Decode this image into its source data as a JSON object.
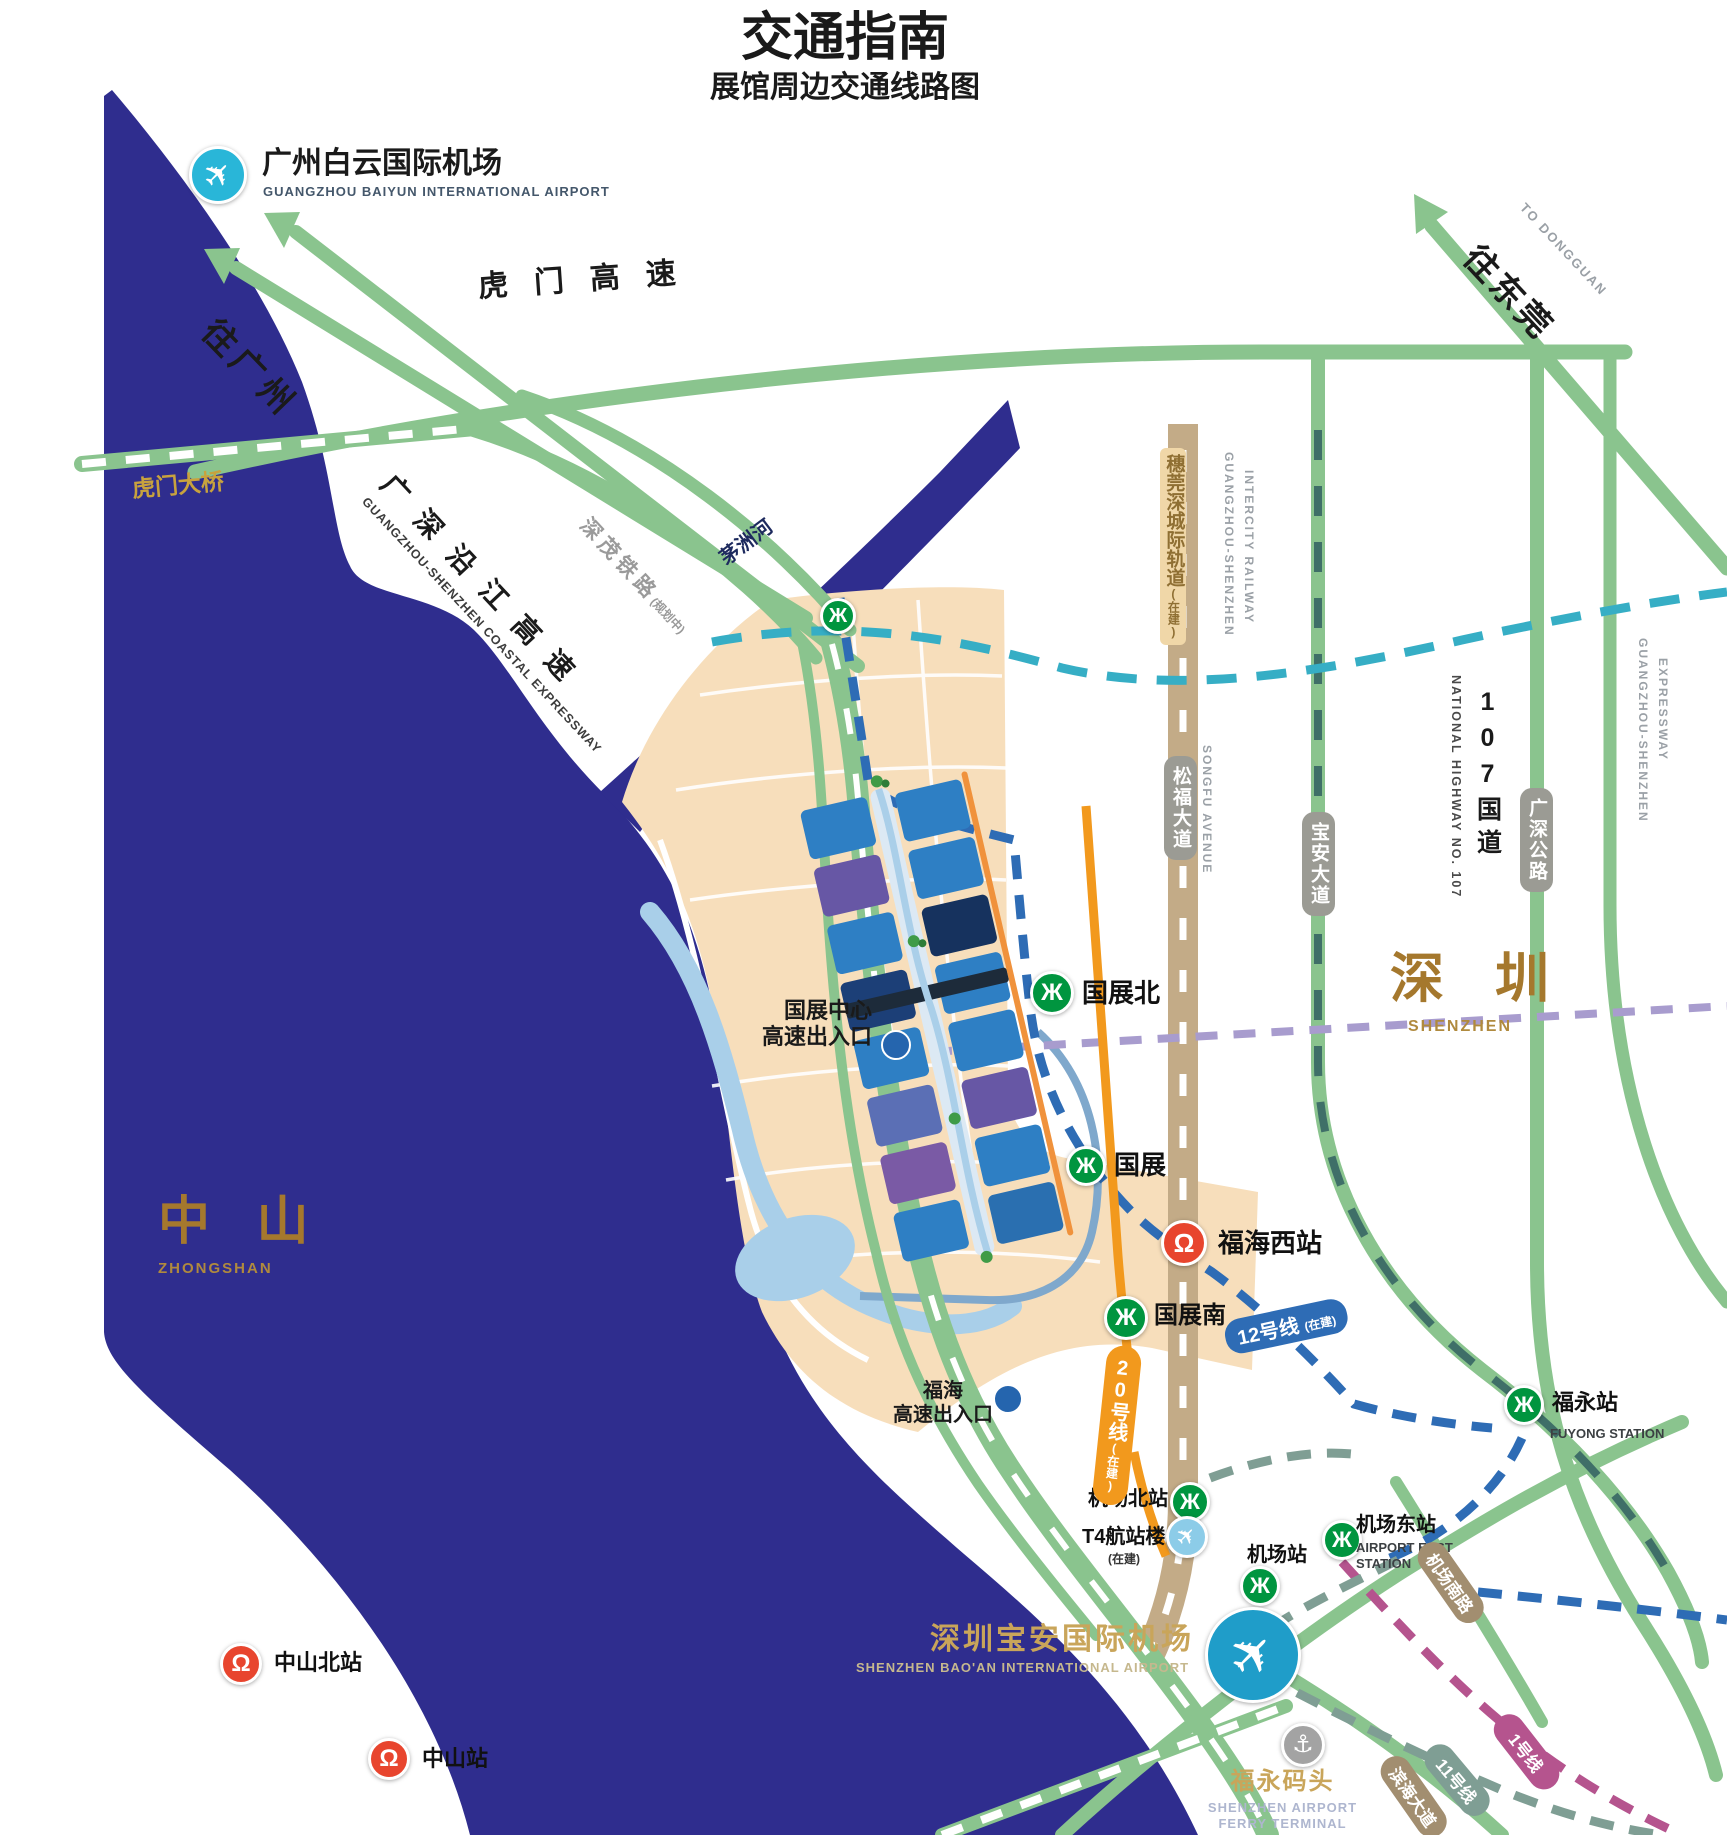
{
  "title": "交通指南",
  "subtitle": "展馆周边交通线路图",
  "airports": {
    "baiyun": {
      "zh": "广州白云国际机场",
      "en": "GUANGZHOU BAIYUN INTERNATIONAL AIRPORT"
    },
    "baoan": {
      "zh": "深圳宝安国际机场",
      "en": "SHENZHEN BAO'AN INTERNATIONAL AIRPORT"
    },
    "t4": {
      "zh": "T4航站楼",
      "note": "(在建)"
    }
  },
  "regions": {
    "shenzhen": {
      "zh": "深 圳",
      "en": "SHENZHEN"
    },
    "zhongshan": {
      "zh": "中 山",
      "en": "ZHONGSHAN"
    }
  },
  "directions": {
    "to_guangzhou": "往广州",
    "to_dongguan": {
      "zh": "往东莞",
      "en": "TO DONGGUAN"
    }
  },
  "roads": {
    "humen_expwy": "虎门高速",
    "humen_bridge": "虎门大桥",
    "coastal": {
      "zh": "广深沿江高速",
      "en": "GUANGZHOU-SHENZHEN COASTAL EXPRESSWAY"
    },
    "shenmao": {
      "zh": "深茂铁路",
      "note": "(规划中)"
    },
    "maozhou_river": "茅洲河",
    "intercity": {
      "zh": "穗莞深城际轨道",
      "note": "(在建)",
      "en1": "GUANGZHOU-SHENZHEN",
      "en2": "INTERCITY RAILWAY"
    },
    "songfu": {
      "zh": "松福大道",
      "en": "SONGFU AVENUE"
    },
    "baoan_ave": "宝安大道",
    "highway107": {
      "zh": "107国道",
      "en": "NATIONAL HIGHWAY NO. 107"
    },
    "gs_highway": "广深公路",
    "gs_expwy": {
      "en1": "GUANGZHOU-SHENZHEN",
      "en2": "EXPRESSWAY"
    },
    "airport_south": "机场南路",
    "binhai": "滨海大道"
  },
  "exits": {
    "center": {
      "line1": "国展中心",
      "line2": "高速出入口"
    },
    "fuhai": {
      "line1": "福海",
      "line2": "高速出入口"
    }
  },
  "stations": {
    "metro": {
      "guozhan_north": "国展北",
      "guozhan": "国展",
      "guozhan_south": "国展南",
      "airport_north": "机场北站",
      "airport": "机场站",
      "airport_east": {
        "zh": "机场东站",
        "en1": "AIRPORT EAST",
        "en2": "STATION"
      },
      "fuyong": {
        "zh": "福永站",
        "en": "FUYONG STATION"
      }
    },
    "rail": {
      "fuhai_west": "福海西站",
      "zhongshan_north": "中山北站",
      "zhongshan": "中山站"
    }
  },
  "ferry": {
    "zh": "福永码头",
    "en1": "SHENZHEN AIRPORT",
    "en2": "FERRY TERMINAL"
  },
  "metro_lines": {
    "line12": {
      "name": "12号线",
      "note": "(在建)"
    },
    "line20": {
      "name": "20号线",
      "note": "(在建)"
    },
    "line11": {
      "name": "11号线"
    },
    "line1": {
      "name": "1号线"
    }
  },
  "colors": {
    "water": "#2f2d8e",
    "road_green": "#8ac48e",
    "zone_tan": "#f7debb",
    "line12_blue": "#2e6cb5",
    "line20_orange": "#f2991d",
    "line11_gray_green": "#7f9e94",
    "line1_magenta": "#b5548e",
    "metro_green": "#00953f",
    "rail_red": "#e8452e",
    "airport_teal": "#1f9dc9",
    "gold": "#c9a55a"
  }
}
